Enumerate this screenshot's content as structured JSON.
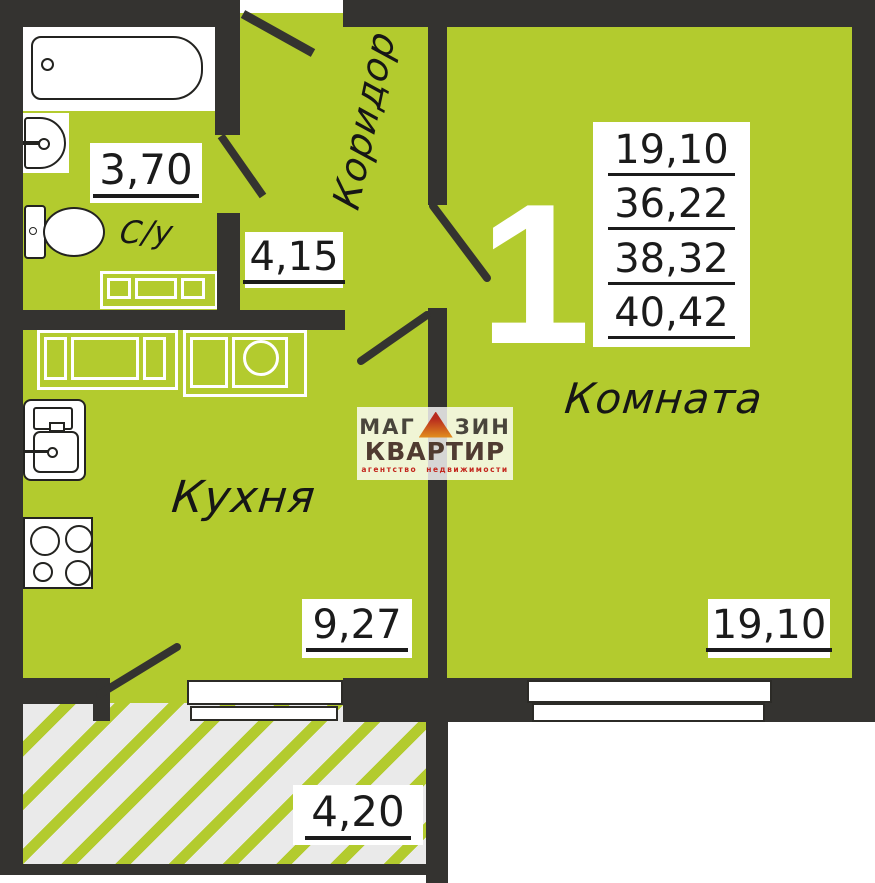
{
  "plan": {
    "type_number": "1",
    "area_summary": [
      "19,10",
      "36,22",
      "38,32",
      "40,42"
    ],
    "rooms": [
      {
        "name": "corridor",
        "label": "Коридор"
      },
      {
        "name": "bathroom",
        "label": "С/у",
        "area": "3,70"
      },
      {
        "name": "hall",
        "area": "4,15"
      },
      {
        "name": "kitchen",
        "label": "Кухня",
        "area": "9,27"
      },
      {
        "name": "living-room",
        "label": "Комната",
        "area": "19,10"
      },
      {
        "name": "balcony",
        "area": "4,20"
      }
    ],
    "logo": {
      "word1_part1": "МАГ",
      "word1_part2": "ЗИН",
      "word2": "КВАРТИР",
      "tagline": "агентство недвижимости"
    }
  },
  "colors": {
    "floor": "#b3cb2e",
    "wall": "#343330",
    "hatch_bg": "#eaeaea",
    "stripe": "#b3cb2e",
    "ink": "#1b1b1b",
    "logo_red": "#b8291e",
    "logo_orange": "#e0891e",
    "logo_brown": "#503b31",
    "logo_gray": "#49453c",
    "tagline_red": "#c3261d"
  }
}
